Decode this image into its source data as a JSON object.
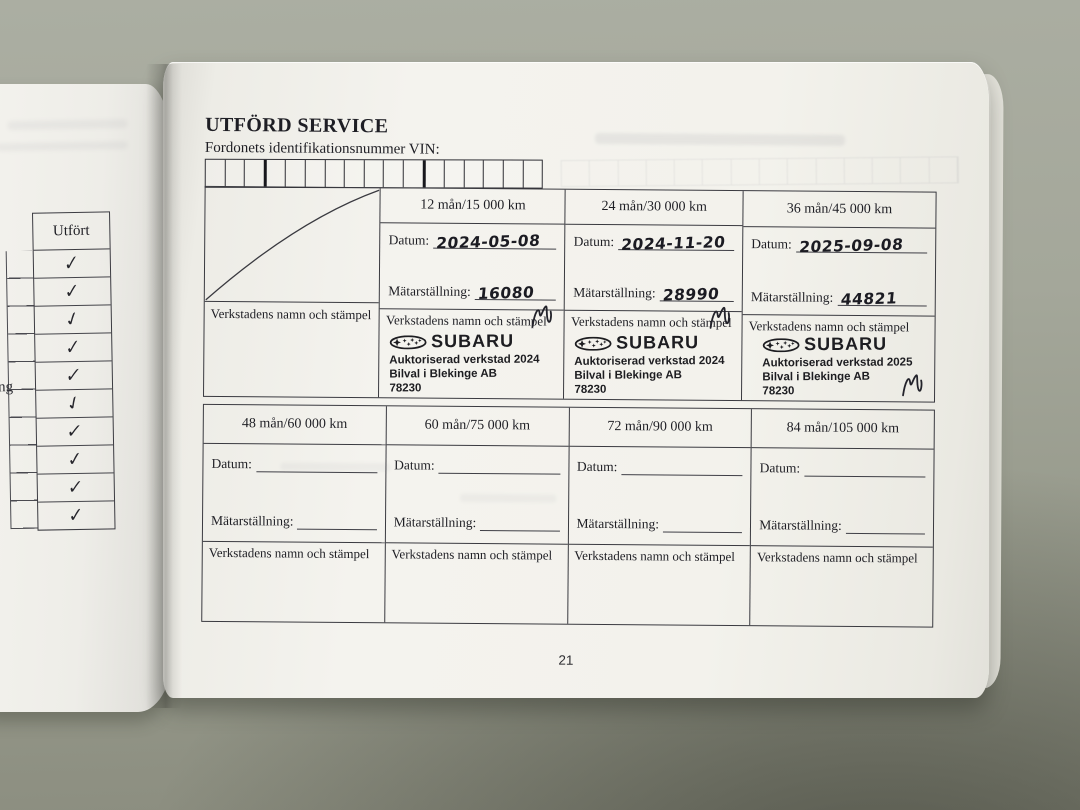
{
  "left_page": {
    "column_header": "Utfört",
    "text_fragment": "ng",
    "checkmarks": [
      "✓",
      "✓",
      "✓",
      "✓",
      "✓",
      "✓",
      "✓",
      "✓",
      "✓",
      "✓"
    ]
  },
  "right_page": {
    "title": "UTFÖRD SERVICE",
    "vin_label": "Fordonets identifikationsnummer VIN:",
    "labels": {
      "datum": "Datum:",
      "matarstallning": "Mätarställning:",
      "stamp": "Verkstadens namn och stämpel"
    },
    "service_intervals_1_36": {
      "columns": [
        {
          "header": "12 mån/15 000 km",
          "datum_value": "2024-05-08",
          "matarstallning_value": "16080",
          "stamp": {
            "brand": "SUBARU",
            "authorized": "Auktoriserad verkstad 2024",
            "company": "Bilval i Blekinge AB",
            "postal_code": "78230"
          }
        },
        {
          "header": "24 mån/30 000 km",
          "datum_value": "2024-11-20",
          "matarstallning_value": "28990",
          "stamp": {
            "brand": "SUBARU",
            "authorized": "Auktoriserad verkstad 2024",
            "company": "Bilval i Blekinge AB",
            "postal_code": "78230"
          }
        },
        {
          "header": "36 mån/45 000 km",
          "datum_value": "2025-09-08",
          "matarstallning_value": "44821",
          "stamp": {
            "brand": "SUBARU",
            "authorized": "Auktoriserad verkstad 2025",
            "company": "Bilval i Blekinge AB",
            "postal_code": "78230"
          }
        }
      ]
    },
    "service_intervals_48_84": {
      "columns": [
        {
          "header": "48 mån/60 000 km"
        },
        {
          "header": "60 mån/75 000 km"
        },
        {
          "header": "72 mån/90 000 km"
        },
        {
          "header": "84 mån/105 000 km"
        }
      ]
    },
    "page_number": "21"
  }
}
